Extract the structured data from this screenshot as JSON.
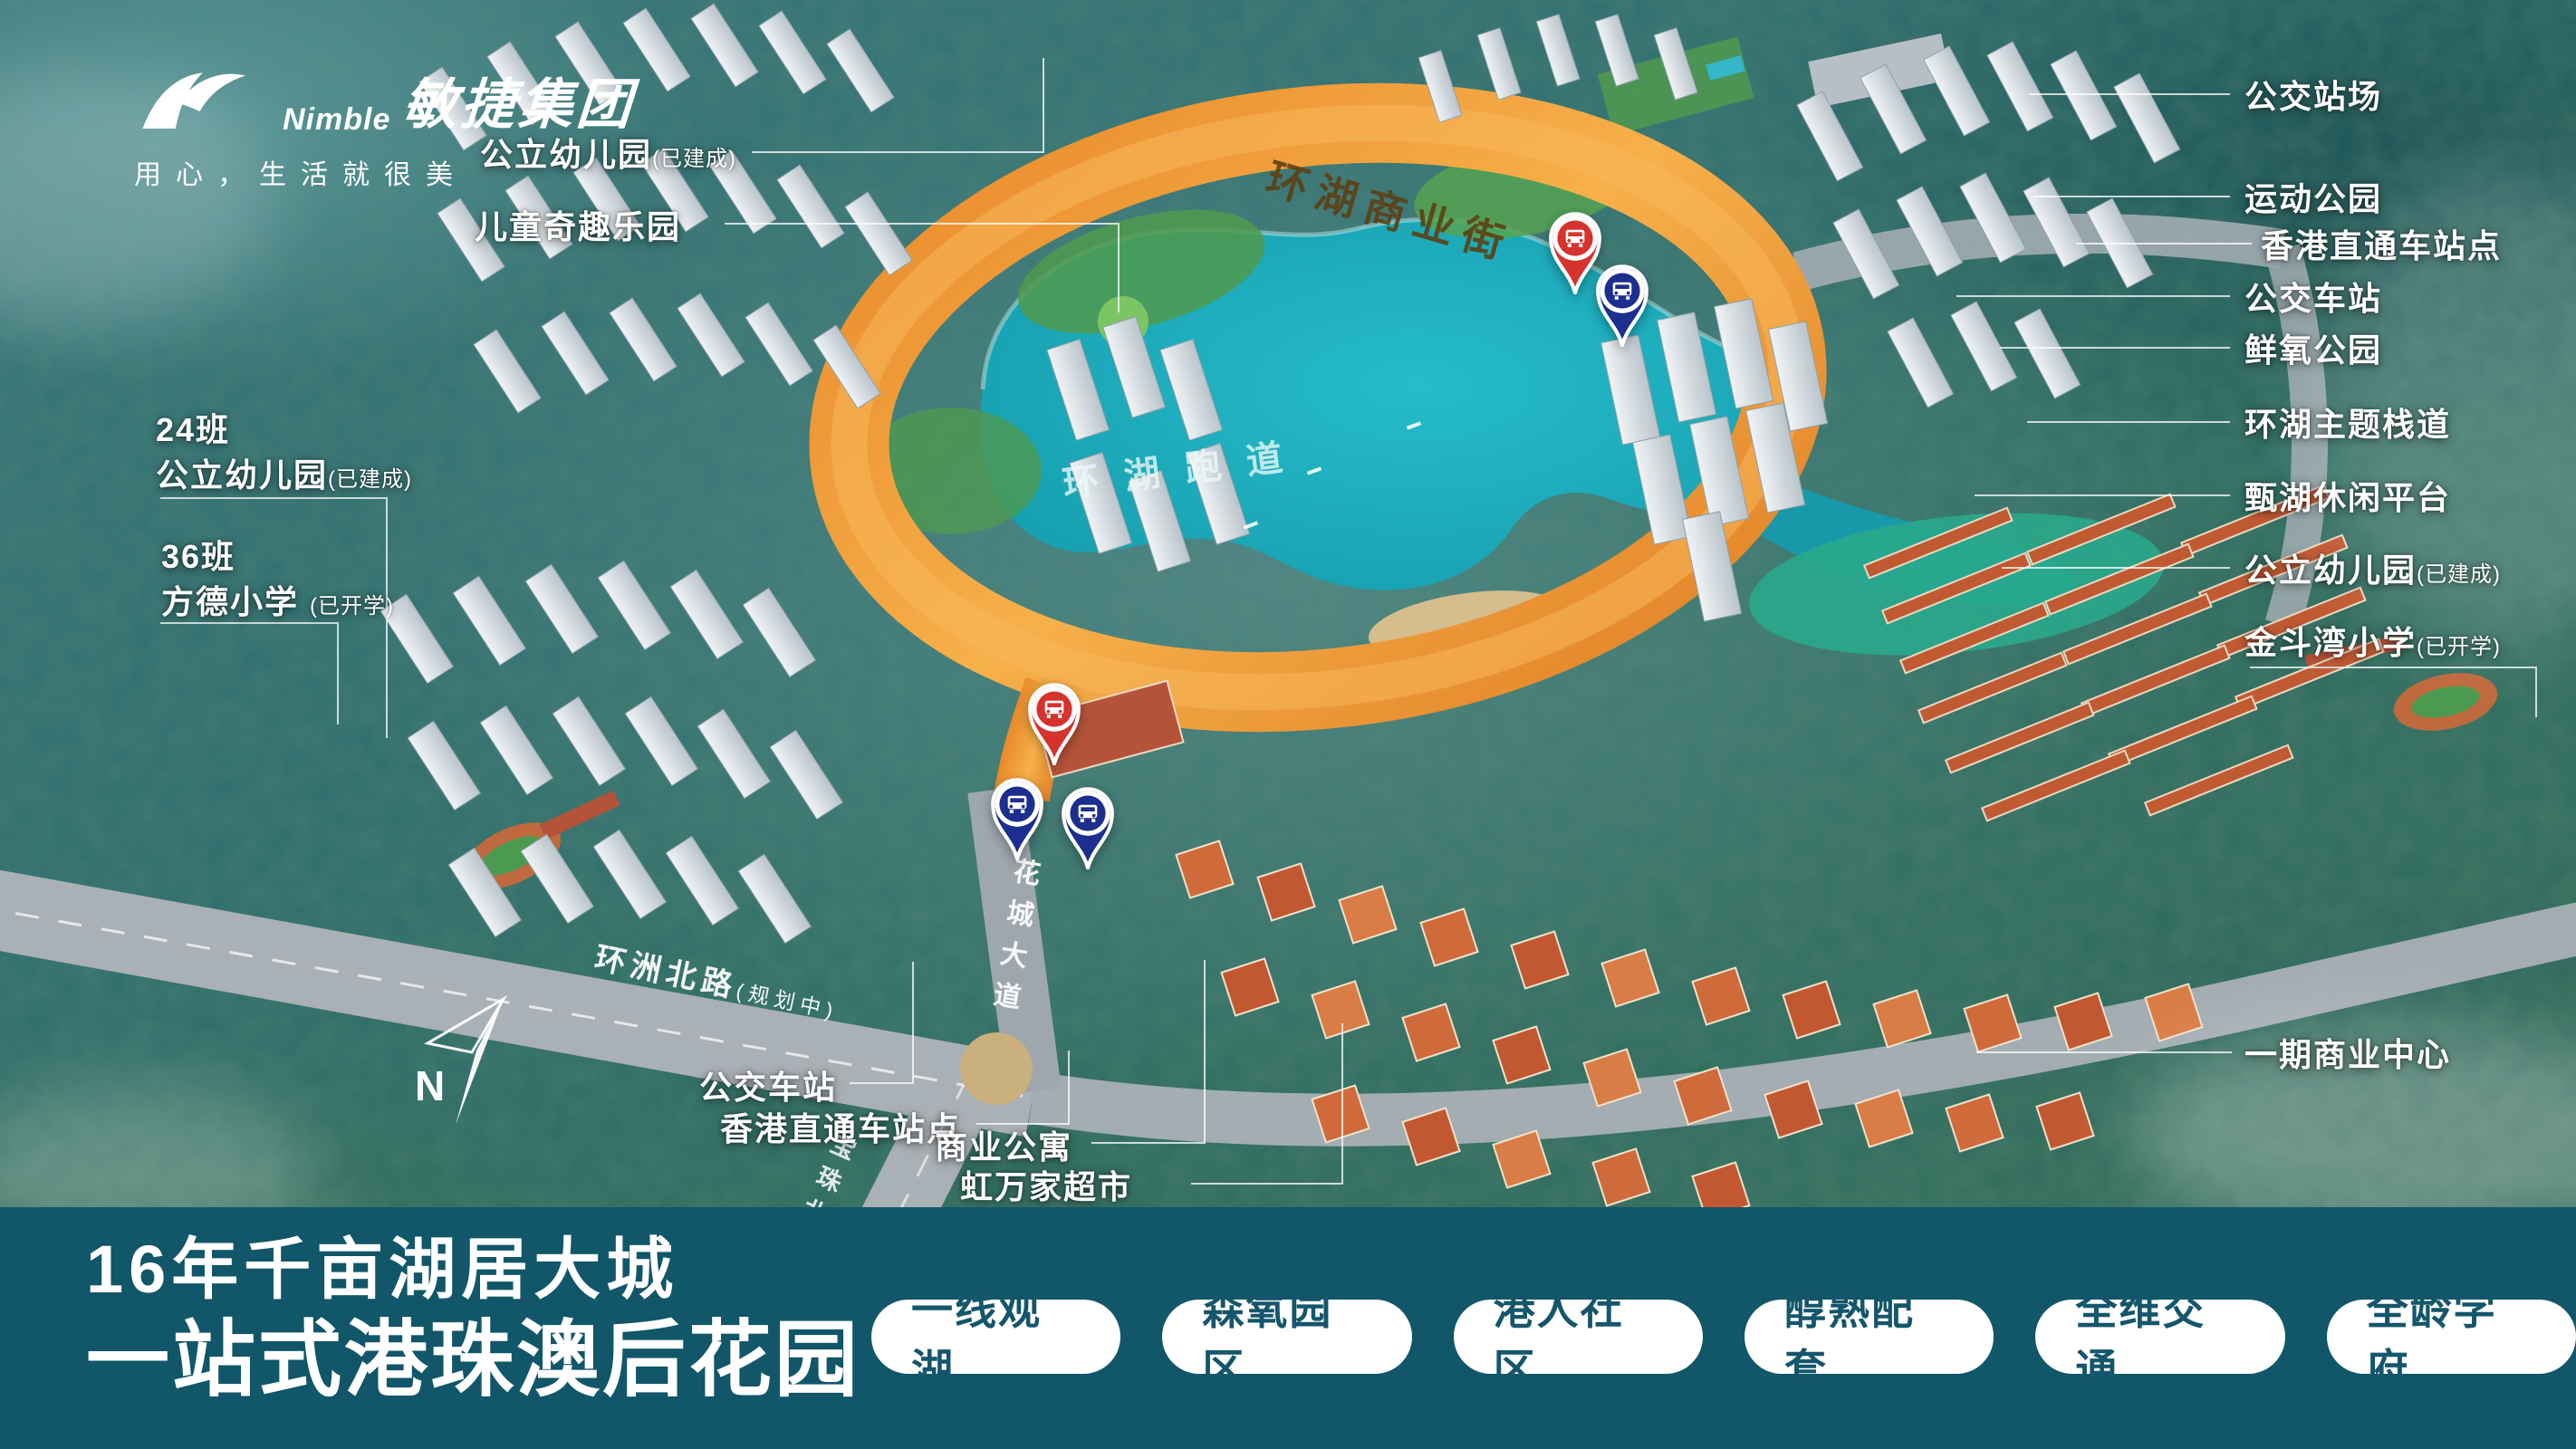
{
  "brand": {
    "logo_en": "Nimble",
    "logo_cn": "敏捷集团",
    "tagline": "用心，生活就很美"
  },
  "callouts": {
    "left": [
      {
        "text": "公立幼儿园",
        "suffix": "(已建成)"
      },
      {
        "text": "儿童奇趣乐园"
      },
      {
        "prefix": "24班",
        "text": "公立幼儿园",
        "suffix": "(已建成)"
      },
      {
        "prefix": "36班",
        "text": "方德小学 ",
        "suffix": "(已开学)"
      }
    ],
    "right": [
      {
        "text": "公交站场"
      },
      {
        "text": "运动公园"
      },
      {
        "text": "香港直通车站点"
      },
      {
        "text": "公交车站"
      },
      {
        "text": "鲜氧公园"
      },
      {
        "text": "环湖主题栈道"
      },
      {
        "text": "甄湖休闲平台"
      },
      {
        "text": "公立幼儿园",
        "suffix": "(已建成)"
      },
      {
        "text": "金斗湾小学",
        "suffix": "(已开学)"
      },
      {
        "text": "一期商业中心"
      }
    ],
    "bottom": [
      {
        "text": "公交车站"
      },
      {
        "text": "香港直通车站点"
      },
      {
        "text": "商业公寓"
      },
      {
        "text": "虹万家超市"
      }
    ]
  },
  "road_labels": {
    "ring_street": "环湖商业街",
    "lake_track": "环湖跑道",
    "huacheng_avenue": "花城大道",
    "huanzhou_road": "环洲北路",
    "huanzhou_suffix": "(规划中)",
    "baozhu_road": "宝珠北路"
  },
  "compass": {
    "label": "N"
  },
  "markers": [
    {
      "name": "bus-station-pin",
      "color": "red"
    },
    {
      "name": "bus-station-pin",
      "color": "navy"
    },
    {
      "name": "bus-station-pin",
      "color": "red"
    },
    {
      "name": "bus-station-pin",
      "color": "navy"
    },
    {
      "name": "bus-station-pin",
      "color": "navy"
    }
  ],
  "banner": {
    "title_line1": "16年千亩湖居大城",
    "title_line2": "一站式港珠澳后花园",
    "pills": [
      "一线观湖",
      "森氧园区",
      "港人社区",
      "醇熟配套",
      "全维交通",
      "全龄学府"
    ]
  },
  "colors": {
    "banner_background": "#115669",
    "pill_text": "#14566b",
    "lake": "#18a3b5",
    "ring_road_orange": "#ef9632",
    "pin_red": "#d6332f",
    "pin_navy": "#1c2e8e"
  }
}
